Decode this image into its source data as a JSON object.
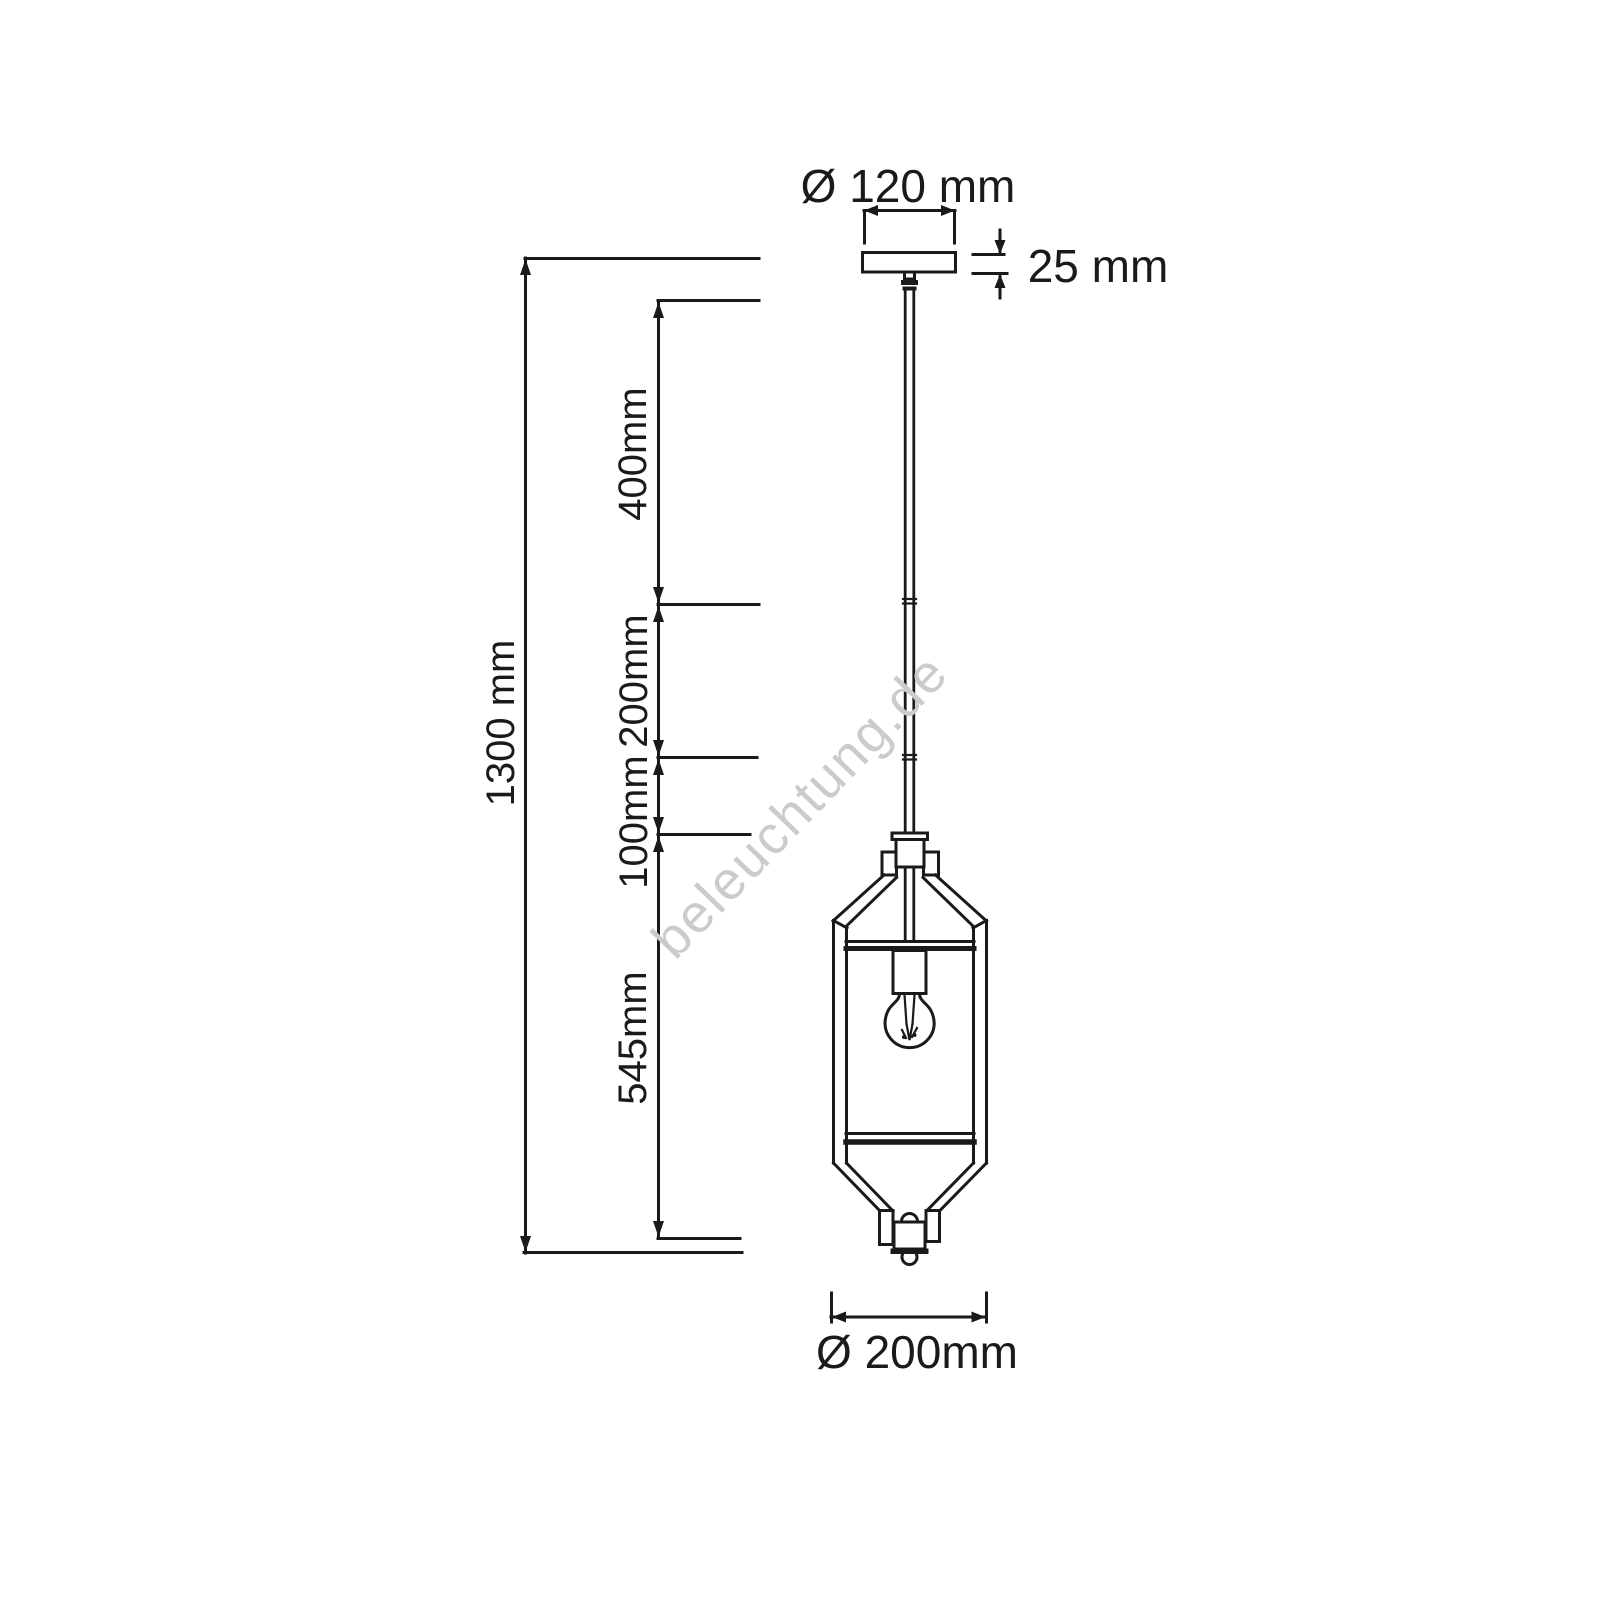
{
  "page": {
    "background_color": "#ffffff",
    "line_color": "#1a1a1a"
  },
  "watermark": {
    "text": "beleuchtung.de",
    "color": "#cbcbcb"
  },
  "dimensions": {
    "canopy_diameter": {
      "label": "Ø 120 mm"
    },
    "canopy_height": {
      "label": "25 mm"
    },
    "total_height": {
      "label": "1300 mm"
    },
    "segments": [
      {
        "label": "400mm"
      },
      {
        "label": "200mm"
      },
      {
        "label": "100mm"
      },
      {
        "label": "545mm"
      }
    ],
    "lantern_diameter": {
      "label": "Ø 200mm"
    }
  }
}
